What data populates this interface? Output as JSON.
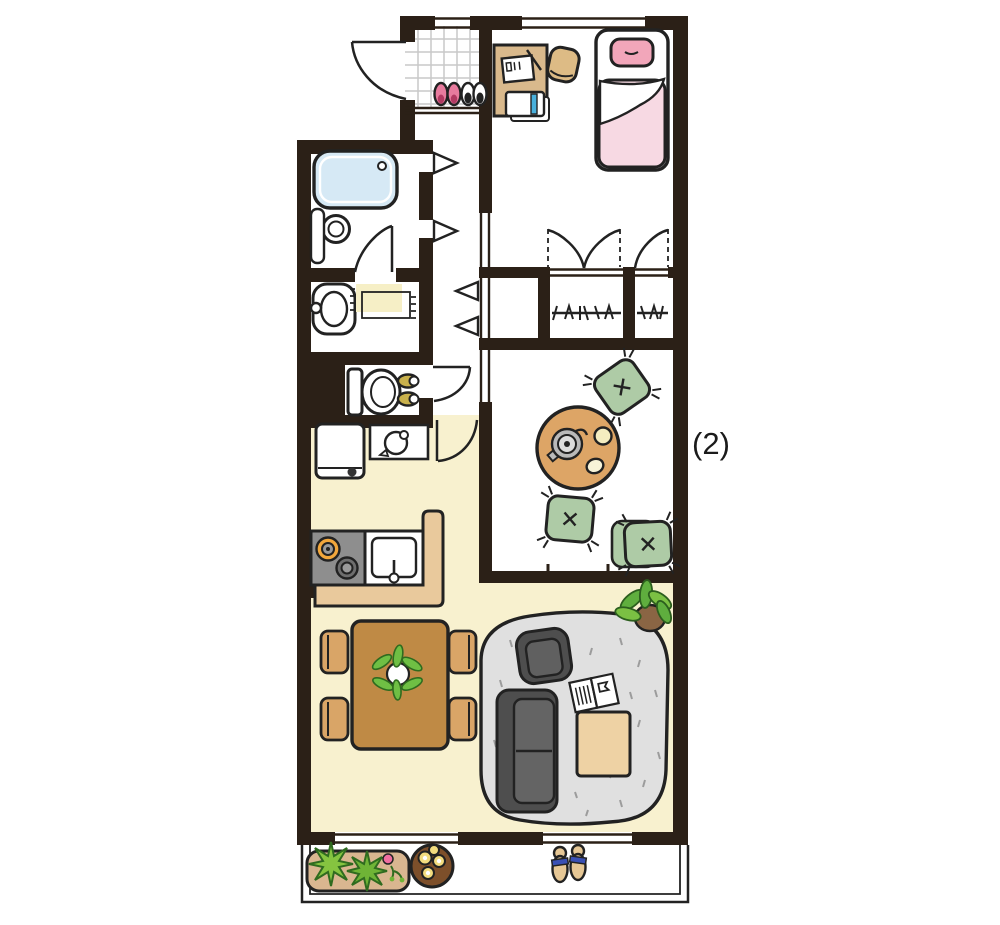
{
  "annotation": {
    "label": "(2)"
  },
  "floor_plan": {
    "type": "apartment-floor-plan",
    "style": "hand-drawn illustration, top-down view",
    "rooms": [
      {
        "name": "entrance-genkan",
        "items": [
          "tiled entry floor",
          "pink shoes pair",
          "dark shoes pair",
          "entry door swing"
        ]
      },
      {
        "name": "bedroom",
        "items": [
          "single bed with pink pillow and pink blanket",
          "desk with notepad and notebook",
          "stool",
          "closet with hanger rods",
          "hinged closet doors"
        ]
      },
      {
        "name": "bathroom",
        "items": [
          "bathtub",
          "shower stool",
          "shelf",
          "door swing"
        ]
      },
      {
        "name": "washroom",
        "items": [
          "washbasin",
          "bath mat with fringe"
        ]
      },
      {
        "name": "toilet-room",
        "items": [
          "toilet",
          "toilet slippers",
          "door swing"
        ]
      },
      {
        "name": "hallway",
        "items": [
          "folding-door symbols",
          "hall closet"
        ]
      },
      {
        "name": "japanese-room",
        "items": [
          "round low table",
          "teapot",
          "two teacups",
          "four green floor cushions",
          "sliding partition"
        ]
      },
      {
        "name": "living-dining-kitchen",
        "items": [
          "refrigerator",
          "kettle shelf",
          "two-burner stove",
          "kitchen sink",
          "L-shaped counter",
          "dining table with potted plant",
          "four chairs",
          "area rug",
          "sofa",
          "armchair",
          "coffee table",
          "open magazine",
          "potted plant"
        ]
      },
      {
        "name": "balcony",
        "items": [
          "planter box with greenery and pink flower",
          "round flower pot with yellow flowers",
          "pair of sandals"
        ]
      }
    ],
    "palette": {
      "wall": "#2b2017",
      "ldk_floor": "#f8f1cf",
      "tile_line": "#c9c9c9",
      "bathtub_blue": "#d6e9f5",
      "mat_cream": "#f6efc6",
      "shoe_pink": "#e87b9e",
      "pillow_pink": "#f2a6ba",
      "blanket_pink": "#f7d9e3",
      "desk_tan": "#d9b98c",
      "accent_blue": "#49b0dc",
      "counter_tan": "#e9c99c",
      "stove_gray": "#8e8e8e",
      "burner_orange": "#f2a73c",
      "dining_table_brown": "#bf8a45",
      "chair_tan": "#d9a567",
      "rug_gray": "#e0e0e0",
      "sofa_gray": "#4e4e4e",
      "coffee_table_tan": "#eed2a4",
      "cushion_green": "#aecba6",
      "low_table_tan": "#dda566",
      "leaf_green": "#85c440",
      "planter_tan": "#d9b690",
      "pot_brown": "#7d4f2a",
      "flower_yellow": "#f3dc7e",
      "flower_pink": "#f06ea0",
      "sandal_tan": "#e6c795",
      "strap_blue": "#3a50b4",
      "slipper_olive": "#c9b14c",
      "teapot_gray": "#b9b9b9"
    }
  }
}
